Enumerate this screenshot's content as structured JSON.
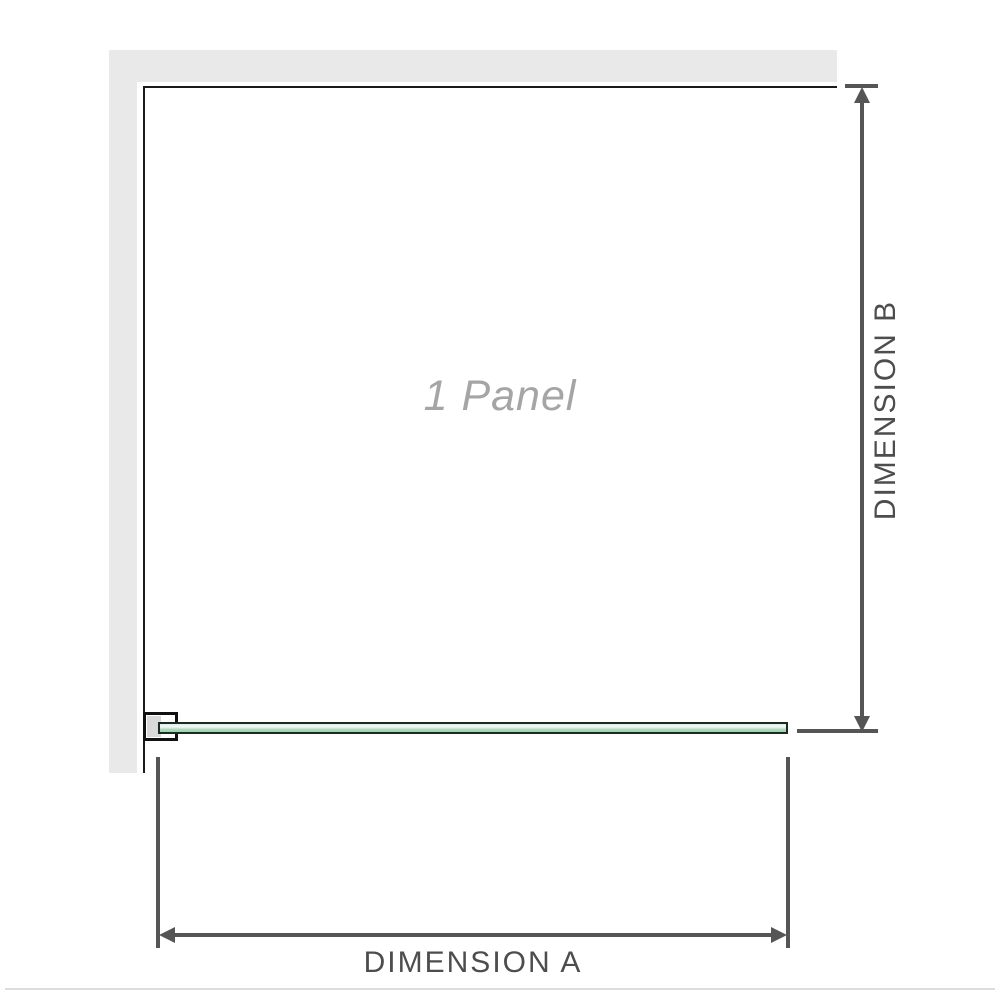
{
  "diagram": {
    "panel_label": "1 Panel",
    "dimension_a_label": "DIMENSION A",
    "dimension_b_label": "DIMENSION B"
  },
  "colors": {
    "wall": "#e9e9e9",
    "panel_outline": "#1a1a1a",
    "glass_border": "#1c2b20",
    "glass_fill_light": "#dff1e6",
    "glass_fill_dark": "#a9d8ba",
    "bracket_pad": "#d9d9d9",
    "dimension_line": "#555555",
    "label_text": "#4d4d4d",
    "panel_label_text": "#a5a5a5",
    "bottom_rule": "#dcdcdc"
  }
}
